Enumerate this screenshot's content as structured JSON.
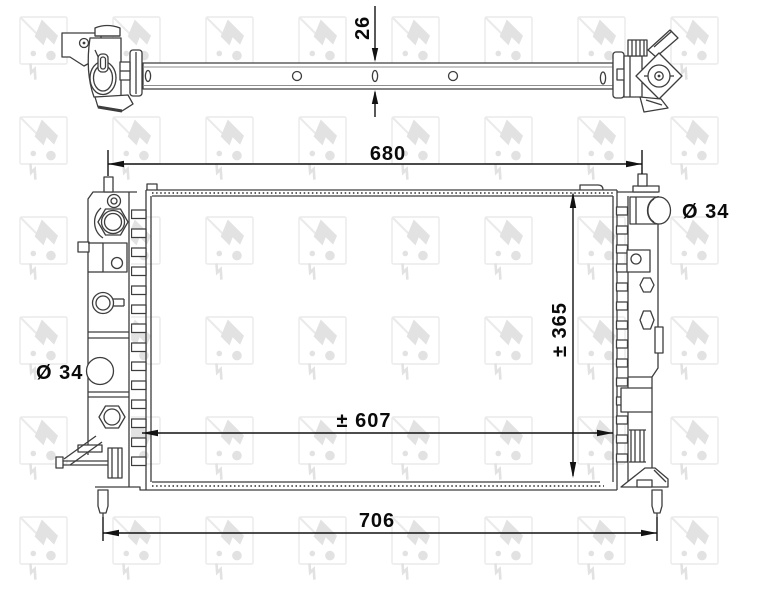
{
  "brand": "NRF",
  "drawing": "radiator-technical-drawing",
  "colors": {
    "line": "#3d3d3d",
    "dimension": "#121212",
    "watermark_outline": "#eaeaea",
    "watermark_glyph": "#e2e2e2",
    "background": "#ffffff"
  },
  "labels": {
    "profile_thickness": "26",
    "top_mount_width": "680",
    "bottom_mount_width": "706",
    "core_width": "± 607",
    "core_height": "± 365",
    "left_port_diameter": "Ø 34",
    "right_port_diameter": "Ø 34"
  }
}
